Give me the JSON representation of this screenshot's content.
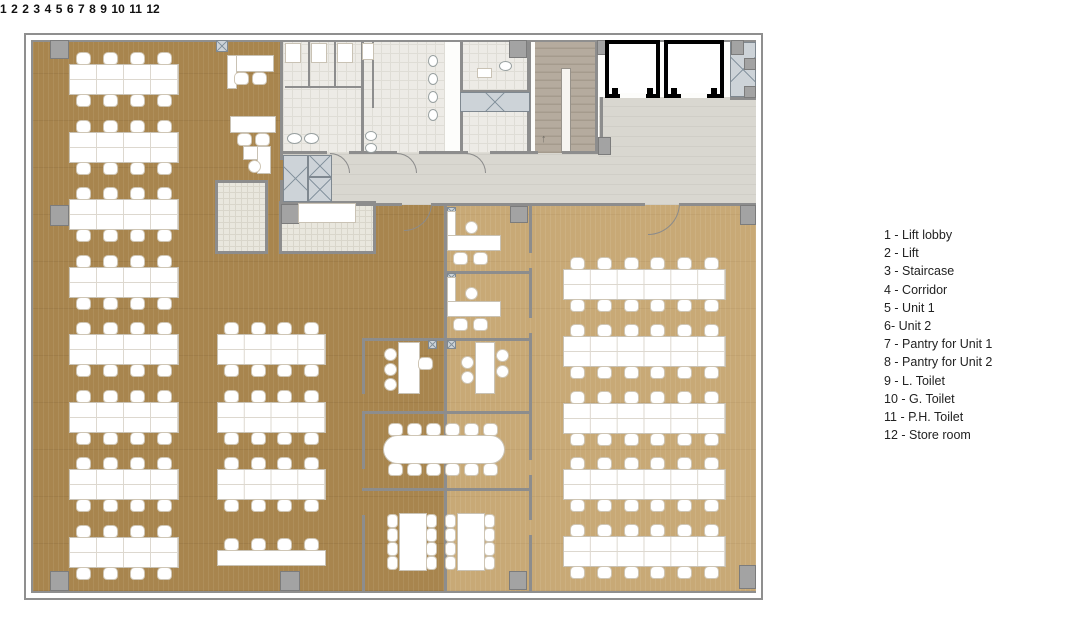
{
  "legend": {
    "items": [
      {
        "text": "1 - Lift lobby"
      },
      {
        "text": "2 - Lift"
      },
      {
        "text": "3 - Staircase"
      },
      {
        "text": "4 - Corridor"
      },
      {
        "text": "5 - Unit 1"
      },
      {
        "text": "6- Unit 2"
      },
      {
        "text": "7 - Pantry for Unit 1"
      },
      {
        "text": "8 - Pantry for Unit 2"
      },
      {
        "text": "9 - L. Toilet"
      },
      {
        "text": "10 - G. Toilet"
      },
      {
        "text": "11 - P.H. Toilet"
      },
      {
        "text": "12 - Store room"
      }
    ]
  },
  "plan": {
    "labels": {
      "lift_lobby": "1",
      "lift_a": "2",
      "lift_b": "2",
      "staircase": "3",
      "corridor": "4",
      "unit1": "5",
      "unit2": "6",
      "pantry_unit1": "7",
      "pantry_unit2": "8",
      "l_toilet": "9",
      "g_toilet": "10",
      "ph_toilet": "11",
      "store_room": "12"
    },
    "stair_arrow": "↑"
  },
  "colors": {
    "unit2_wood": "#a8854e",
    "unit1_wood": "#c8a976",
    "corridor_floor": "#d9d7d0",
    "tile_floor": "#edebe6",
    "stair_floor": "#b5ab9e",
    "wall": "#8d8d8d",
    "lift_wall": "#000000",
    "shaft_hatch": "#cdd3d8"
  },
  "plan_geometry": {
    "desk_groups": [
      {
        "x": 70,
        "y": 65,
        "w": 108,
        "h": 29,
        "rows": 8,
        "pitch": 67.5,
        "seats": 4
      },
      {
        "x": 218,
        "y": 335,
        "w": 107,
        "h": 29,
        "rows": 3,
        "pitch": 67.5,
        "seats": 4
      },
      {
        "x": 564,
        "y": 270,
        "w": 161,
        "h": 29,
        "rows": 5,
        "pitch": 66.8,
        "seats": 6
      }
    ],
    "walls": [
      [
        283,
        151,
        44,
        3
      ],
      [
        349,
        151,
        48,
        3
      ],
      [
        419,
        151,
        49,
        3
      ],
      [
        490,
        151,
        48,
        3
      ],
      [
        562,
        151,
        38,
        3
      ],
      [
        283,
        203,
        119,
        3
      ],
      [
        432,
        203,
        213,
        3
      ],
      [
        680,
        203,
        76,
        3
      ],
      [
        444,
        205,
        3,
        386
      ],
      [
        529,
        205,
        3,
        48
      ],
      [
        529,
        268,
        3,
        50
      ],
      [
        529,
        333,
        3,
        78
      ],
      [
        529,
        411,
        3,
        49
      ],
      [
        529,
        475,
        3,
        45
      ],
      [
        529,
        535,
        3,
        56
      ],
      [
        447,
        271,
        82,
        3
      ],
      [
        362,
        338,
        167,
        3
      ],
      [
        362,
        338,
        3,
        56
      ],
      [
        362,
        411,
        169,
        3
      ],
      [
        362,
        411,
        3,
        58
      ],
      [
        362,
        488,
        169,
        3
      ],
      [
        362,
        515,
        3,
        76
      ],
      [
        280,
        42,
        3,
        118
      ],
      [
        280,
        180,
        3,
        22
      ],
      [
        215,
        180,
        53,
        3
      ],
      [
        215,
        180,
        3,
        73
      ],
      [
        215,
        251,
        53,
        3
      ],
      [
        265,
        180,
        3,
        73
      ],
      [
        279,
        201,
        97,
        3
      ],
      [
        373,
        201,
        3,
        52
      ],
      [
        279,
        251,
        97,
        3
      ],
      [
        279,
        201,
        3,
        52
      ],
      [
        361,
        42,
        3,
        109
      ],
      [
        308,
        42,
        2,
        46
      ],
      [
        334,
        42,
        2,
        46
      ],
      [
        285,
        86,
        78,
        2
      ],
      [
        372,
        42,
        2,
        66
      ],
      [
        460,
        42,
        3,
        111
      ],
      [
        527,
        42,
        4,
        111
      ],
      [
        460,
        90,
        70,
        2
      ],
      [
        460,
        110,
        70,
        2
      ],
      [
        595,
        42,
        3,
        111
      ],
      [
        600,
        97,
        3,
        42
      ],
      [
        730,
        97,
        26,
        3
      ]
    ],
    "columns": [
      [
        50,
        40,
        19,
        19
      ],
      [
        50,
        205,
        19,
        21
      ],
      [
        50,
        571,
        19,
        20
      ],
      [
        280,
        571,
        20,
        20
      ],
      [
        509,
        571,
        18,
        19
      ],
      [
        739,
        565,
        17,
        24
      ],
      [
        740,
        205,
        16,
        20
      ],
      [
        509,
        40,
        18,
        18
      ],
      [
        597,
        40,
        13,
        15
      ],
      [
        731,
        40,
        13,
        15
      ],
      [
        744,
        58,
        12,
        12
      ],
      [
        744,
        86,
        12,
        12
      ],
      [
        281,
        204,
        18,
        20
      ],
      [
        510,
        206,
        18,
        17
      ],
      [
        598,
        137,
        13,
        18
      ]
    ],
    "shafts": [
      [
        283,
        155,
        25,
        47
      ],
      [
        308,
        155,
        24,
        22
      ],
      [
        308,
        177,
        24,
        25
      ],
      [
        460,
        92,
        70,
        20
      ],
      [
        730,
        42,
        26,
        55
      ],
      [
        216,
        40,
        12,
        12
      ],
      [
        447,
        207,
        9,
        9
      ],
      [
        447,
        273,
        9,
        9
      ],
      [
        428,
        340,
        9,
        9
      ],
      [
        447,
        340,
        9,
        9
      ]
    ],
    "whites": [
      [
        448,
        212,
        7,
        26
      ],
      [
        448,
        236,
        52,
        14
      ],
      [
        448,
        278,
        7,
        26
      ],
      [
        448,
        302,
        52,
        14
      ],
      [
        399,
        343,
        20,
        50
      ],
      [
        476,
        343,
        18,
        50
      ],
      [
        228,
        56,
        45,
        15
      ],
      [
        228,
        56,
        8,
        32
      ],
      [
        231,
        117,
        44,
        15
      ],
      [
        244,
        147,
        26,
        12
      ],
      [
        258,
        147,
        12,
        26
      ],
      [
        400,
        514,
        26,
        56
      ],
      [
        458,
        514,
        26,
        56
      ],
      [
        299,
        204,
        56,
        18
      ],
      [
        218,
        551,
        107,
        14
      ],
      [
        384,
        436,
        120,
        27,
        14
      ],
      [
        286,
        44,
        14,
        18
      ],
      [
        312,
        44,
        14,
        18
      ],
      [
        338,
        44,
        14,
        18
      ],
      [
        363,
        44,
        10,
        15
      ],
      [
        478,
        69,
        13,
        8
      ]
    ],
    "ellipses": [
      [
        287,
        133,
        15,
        11
      ],
      [
        304,
        133,
        15,
        11
      ],
      [
        365,
        131,
        12,
        10
      ],
      [
        365,
        143,
        12,
        10
      ],
      [
        499,
        61,
        13,
        10
      ],
      [
        428,
        55,
        10,
        12
      ],
      [
        428,
        73,
        10,
        12
      ],
      [
        428,
        91,
        10,
        12
      ],
      [
        428,
        109,
        10,
        12
      ]
    ],
    "chairs": [
      [
        225,
        539
      ],
      [
        252,
        539
      ],
      [
        278,
        539
      ],
      [
        305,
        539
      ],
      [
        454,
        253
      ],
      [
        474,
        253
      ],
      [
        454,
        319
      ],
      [
        474,
        319
      ],
      [
        419,
        358
      ],
      [
        235,
        73
      ],
      [
        253,
        73
      ],
      [
        238,
        134
      ],
      [
        256,
        134
      ],
      [
        389,
        424
      ],
      [
        408,
        424
      ],
      [
        427,
        424
      ],
      [
        446,
        424
      ],
      [
        465,
        424
      ],
      [
        484,
        424
      ],
      [
        389,
        464
      ],
      [
        408,
        464
      ],
      [
        427,
        464
      ],
      [
        446,
        464
      ],
      [
        465,
        464
      ],
      [
        484,
        464
      ]
    ],
    "rchairs": [
      [
        466,
        222
      ],
      [
        466,
        288
      ],
      [
        385,
        349
      ],
      [
        385,
        364
      ],
      [
        385,
        379
      ],
      [
        462,
        357
      ],
      [
        462,
        372
      ],
      [
        497,
        350
      ],
      [
        497,
        366
      ],
      [
        249,
        161
      ]
    ],
    "schairs": [
      [
        388,
        515
      ],
      [
        388,
        529
      ],
      [
        388,
        543
      ],
      [
        388,
        557
      ],
      [
        427,
        515
      ],
      [
        427,
        529
      ],
      [
        427,
        543
      ],
      [
        427,
        557
      ],
      [
        446,
        515
      ],
      [
        446,
        529
      ],
      [
        446,
        543
      ],
      [
        446,
        557
      ],
      [
        485,
        515
      ],
      [
        485,
        529
      ],
      [
        485,
        543
      ],
      [
        485,
        557
      ]
    ],
    "arcs": [
      [
        404,
        203,
        28,
        "br"
      ],
      [
        648,
        203,
        32,
        "br"
      ],
      [
        330,
        153,
        20,
        "tr"
      ],
      [
        397,
        153,
        20,
        "tr"
      ],
      [
        466,
        153,
        20,
        "tr"
      ]
    ]
  }
}
